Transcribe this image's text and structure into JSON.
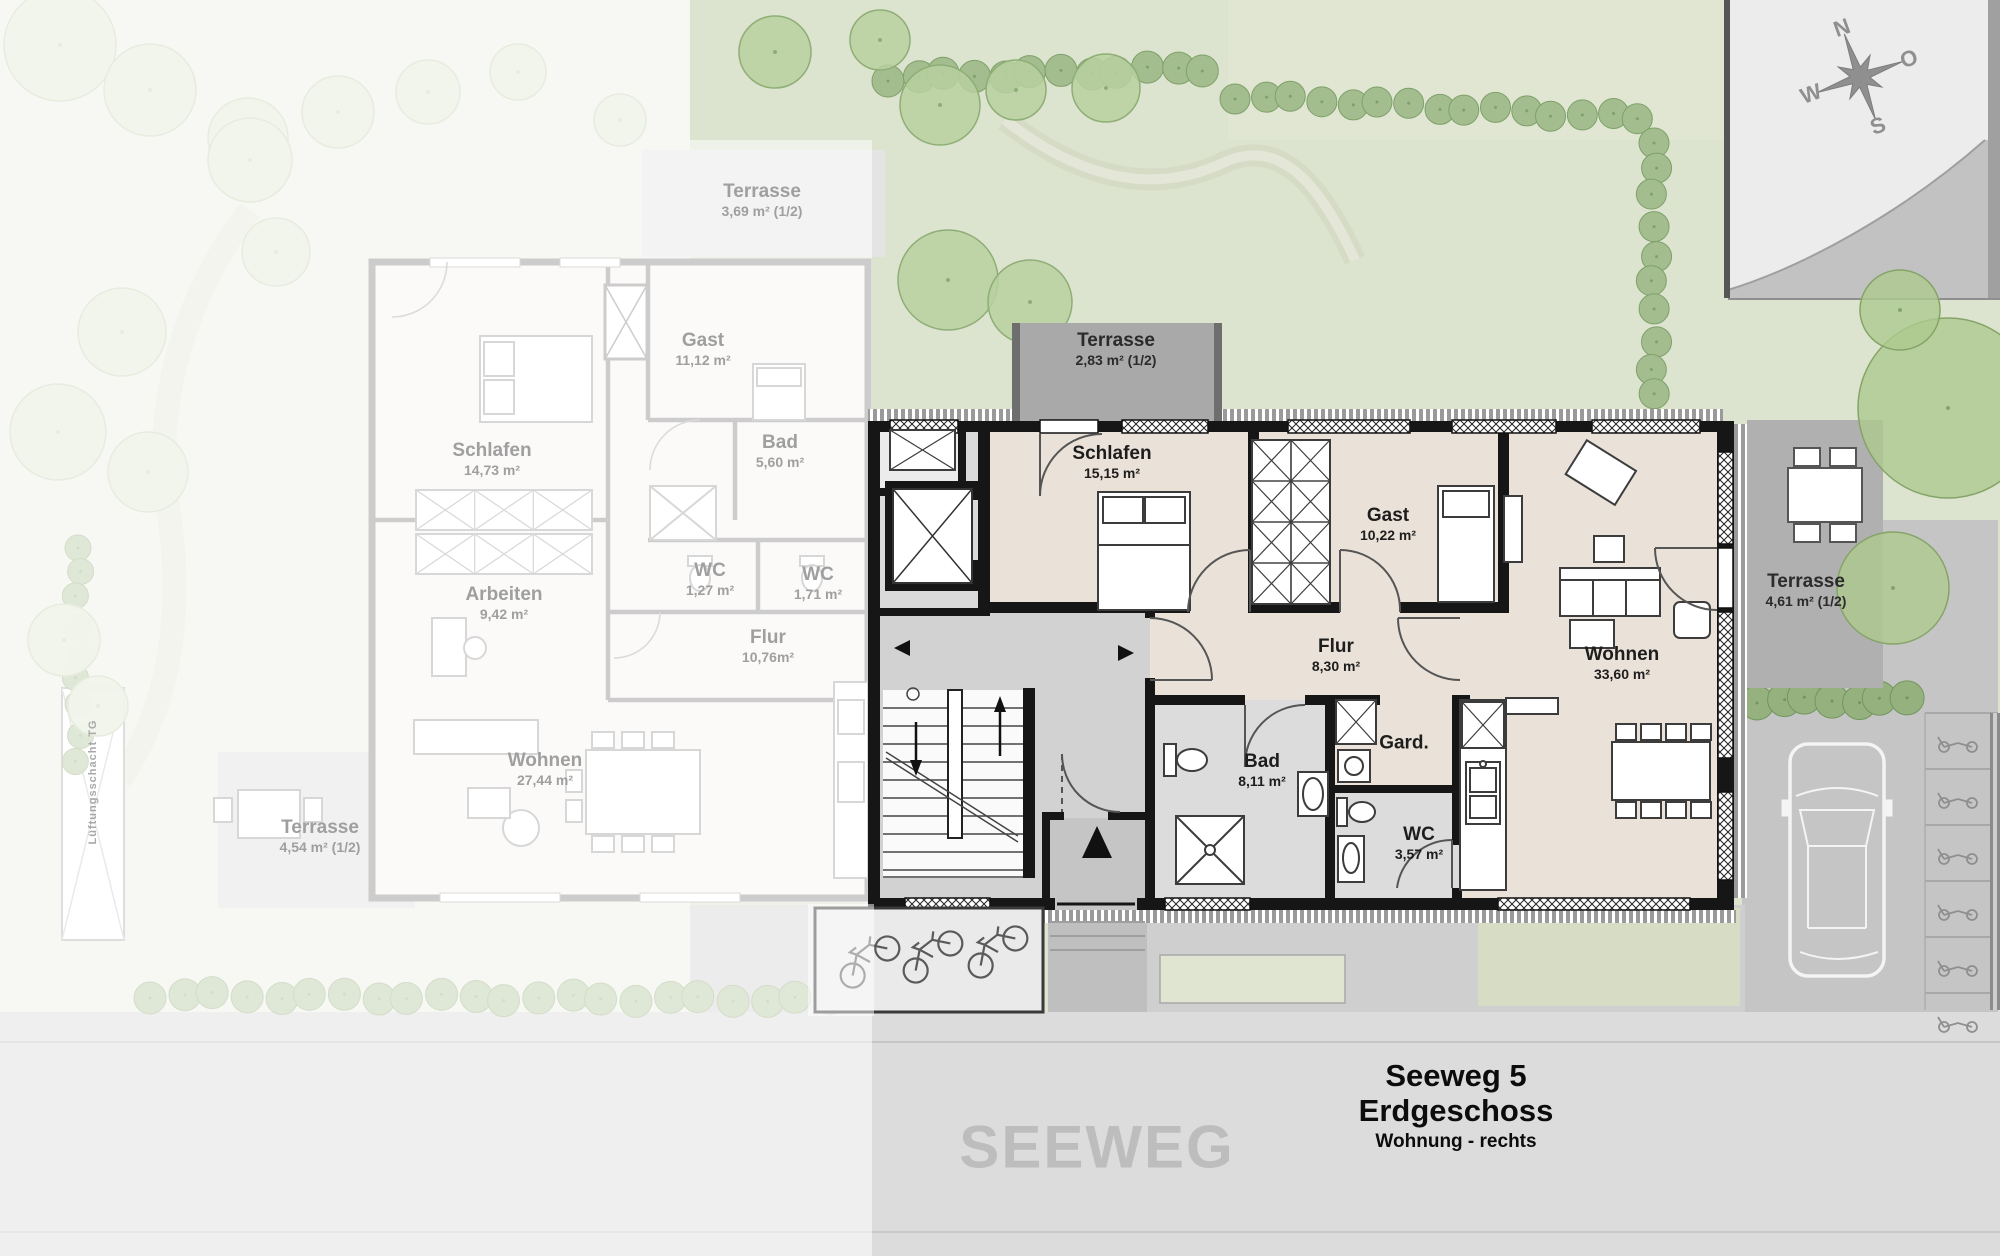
{
  "plan": {
    "title_line1": "Seeweg 5",
    "title_line2": "Erdgeschoss",
    "title_line3": "Wohnung - rechts",
    "street_label": "SEEWEG",
    "shaft_label": "Lüftungsschacht TG"
  },
  "compass": {
    "north": "N",
    "east": "O",
    "south": "S",
    "west": "W"
  },
  "apartment_right": {
    "rooms": [
      {
        "name": "Terrasse",
        "area": "2,83 m² (1/2)"
      },
      {
        "name": "Schlafen",
        "area": "15,15 m²"
      },
      {
        "name": "Gast",
        "area": "10,22 m²"
      },
      {
        "name": "Flur",
        "area": "8,30 m²"
      },
      {
        "name": "Bad",
        "area": "8,11 m²"
      },
      {
        "name": "Gard.",
        "area": ""
      },
      {
        "name": "WC",
        "area": "3,57 m²"
      },
      {
        "name": "Wohnen",
        "area": "33,60 m²"
      },
      {
        "name": "Terrasse",
        "area": "4,61 m² (1/2)"
      }
    ]
  },
  "apartment_left": {
    "rooms": [
      {
        "name": "Terrasse",
        "area": "3,69 m² (1/2)"
      },
      {
        "name": "Gast",
        "area": "11,12 m²"
      },
      {
        "name": "Schlafen",
        "area": "14,73 m²"
      },
      {
        "name": "Bad",
        "area": "5,60 m²"
      },
      {
        "name": "WC",
        "area": "1,27 m²"
      },
      {
        "name": "WC",
        "area": "1,71 m²"
      },
      {
        "name": "Arbeiten",
        "area": "9,42 m²"
      },
      {
        "name": "Flur",
        "area": "10,76m²"
      },
      {
        "name": "Wohnen",
        "area": "27,44 m²"
      },
      {
        "name": "Terrasse",
        "area": "4,54 m² (1/2)"
      }
    ]
  },
  "colors": {
    "wall": "#161616",
    "floor_apartment": "#eae2d8",
    "terrace_gray": "#a9a9a9",
    "garden_green": "#dce3cf",
    "hedge_green": "#a3bd8e",
    "street_gray": "#dcdcdc",
    "label_dark": "#1d1d1d",
    "label_faded": "#9f9f9f"
  }
}
